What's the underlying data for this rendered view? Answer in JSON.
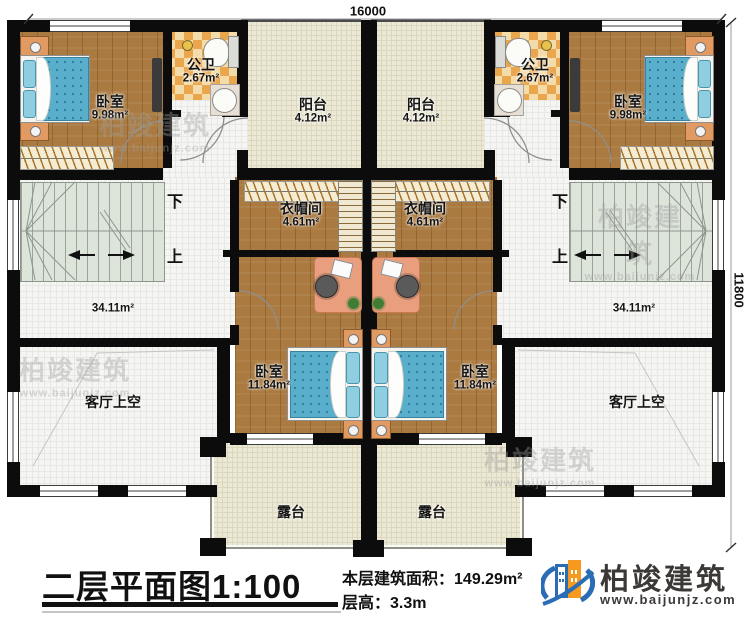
{
  "plan": {
    "dim_top": "16000",
    "dim_right": "11800",
    "stair_down": "下",
    "stair_up": "上",
    "rooms": {
      "bedroom_tl": {
        "name": "卧室",
        "area": "9.98m²"
      },
      "bathroom_l": {
        "name": "公卫",
        "area": "2.67m²"
      },
      "balcony_l": {
        "name": "阳台",
        "area": "4.12m²"
      },
      "balcony_r": {
        "name": "阳台",
        "area": "4.12m²"
      },
      "bathroom_r": {
        "name": "公卫",
        "area": "2.67m²"
      },
      "bedroom_tr": {
        "name": "卧室",
        "area": "9.98m²"
      },
      "cloakroom_l": {
        "name": "衣帽间",
        "area": "4.61m²"
      },
      "cloakroom_r": {
        "name": "衣帽间",
        "area": "4.61m²"
      },
      "hall_l": {
        "area": "34.11m²"
      },
      "hall_r": {
        "area": "34.11m²"
      },
      "bedroom_bl": {
        "name": "卧室",
        "area": "11.84m²"
      },
      "bedroom_br": {
        "name": "卧室",
        "area": "11.84m²"
      },
      "terrace_l": {
        "name": "露台"
      },
      "terrace_r": {
        "name": "露台"
      },
      "void_l": {
        "name": "客厅上空"
      },
      "void_r": {
        "name": "客厅上空"
      }
    }
  },
  "footer": {
    "title": "二层平面图",
    "scale": "1:100",
    "area_label": "本层建筑面积：",
    "area_value": "149.29m²",
    "height_label": "层高：",
    "height_value": "3.3m"
  },
  "brand": {
    "name": "柏竣建筑",
    "website": "www.baijunjz.com"
  },
  "watermark": {
    "name": "柏竣建筑",
    "website": "www.baijunjz.com"
  }
}
